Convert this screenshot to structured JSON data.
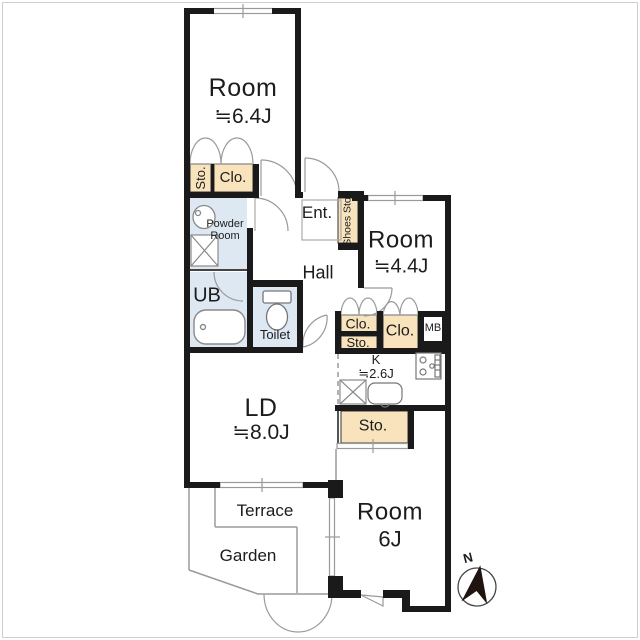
{
  "title": "apartment-floor-plan",
  "colors": {
    "wall": "#1a1a1a",
    "closet_fill": "#f8e3bc",
    "wet_area_fill": "#dde8f3",
    "thin_line": "#999999",
    "background": "#ffffff"
  },
  "labels": {
    "room_top_name": "Room",
    "room_top_size": "≒6.4J",
    "sto_top": "Sto.",
    "clo_top": "Clo.",
    "powder_room": "Powder Room",
    "ub": "UB",
    "toilet": "Toilet",
    "ent": "Ent.",
    "shoes_sto": "Shoes Sto.",
    "hall": "Hall",
    "room_right_name": "Room",
    "room_right_size": "≒4.4J",
    "clo_a": "Clo.",
    "sto_a": "Sto.",
    "clo_b": "Clo.",
    "mb": "MB",
    "kitchen_name": "K",
    "kitchen_size": "≒2.6J",
    "sto_kitchen": "Sto.",
    "ld_name": "LD",
    "ld_size": "≒8.0J",
    "terrace": "Terrace",
    "garden": "Garden",
    "room_bottom_name": "Room",
    "room_bottom_size": "6J",
    "compass_n": "N"
  },
  "icons": {
    "bathtub": "bathtub-icon",
    "toilet": "toilet-icon",
    "washbasin": "washbasin-icon",
    "washer_pan": "washer-pan-icon",
    "stove": "stove-icon",
    "sink": "sink-icon",
    "compass": "north-compass-icon"
  }
}
